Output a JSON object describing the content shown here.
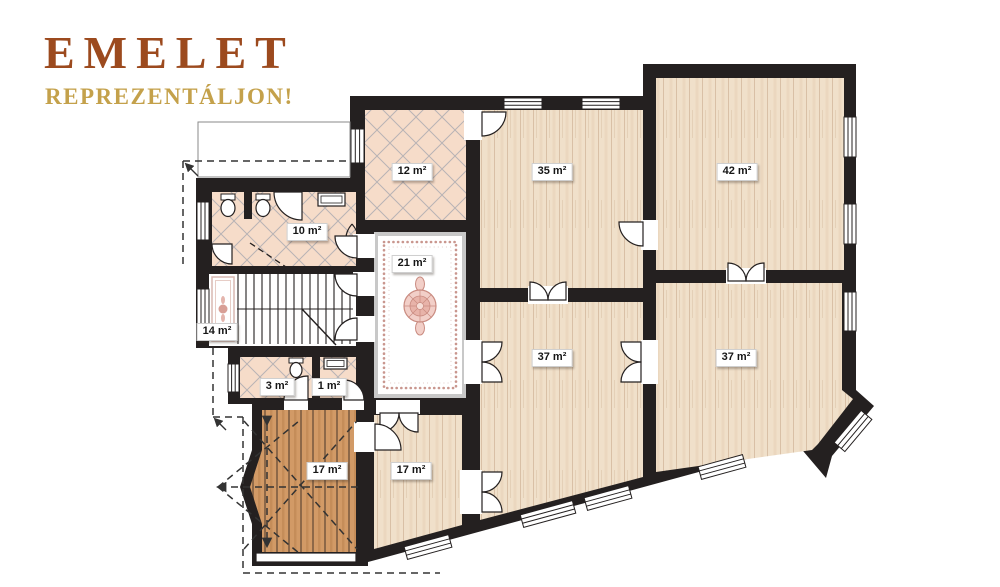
{
  "title": {
    "heading": "EMELET",
    "subheading": "REPREZENTÁLJON!"
  },
  "palette": {
    "title_color": "#9c4a1e",
    "subtitle_color": "#c4a14b",
    "wall": "#242020",
    "wood_light": "#f0e0ca",
    "wood_dark": "#d29a66",
    "tile": "#f6dcc9",
    "hall_floor": "#ffffff",
    "carpet_accent": "#c9968e",
    "label_bg": "#ffffff",
    "label_text": "#161616"
  },
  "rooms": [
    {
      "key": "tiled-room",
      "area": "12 m²"
    },
    {
      "key": "room-top-middle",
      "area": "35 m²"
    },
    {
      "key": "room-top-right",
      "area": "42 m²"
    },
    {
      "key": "bathroom",
      "area": "10 m²"
    },
    {
      "key": "hall",
      "area": "21 m²"
    },
    {
      "key": "staircase",
      "area": "14 m²"
    },
    {
      "key": "wc",
      "area": "3 m²"
    },
    {
      "key": "closet",
      "area": "1 m²"
    },
    {
      "key": "room-mid-left",
      "area": "37 m²"
    },
    {
      "key": "room-mid-right",
      "area": "37 m²"
    },
    {
      "key": "terrace",
      "area": "17 m²"
    },
    {
      "key": "room-bottom",
      "area": "17 m²"
    }
  ]
}
